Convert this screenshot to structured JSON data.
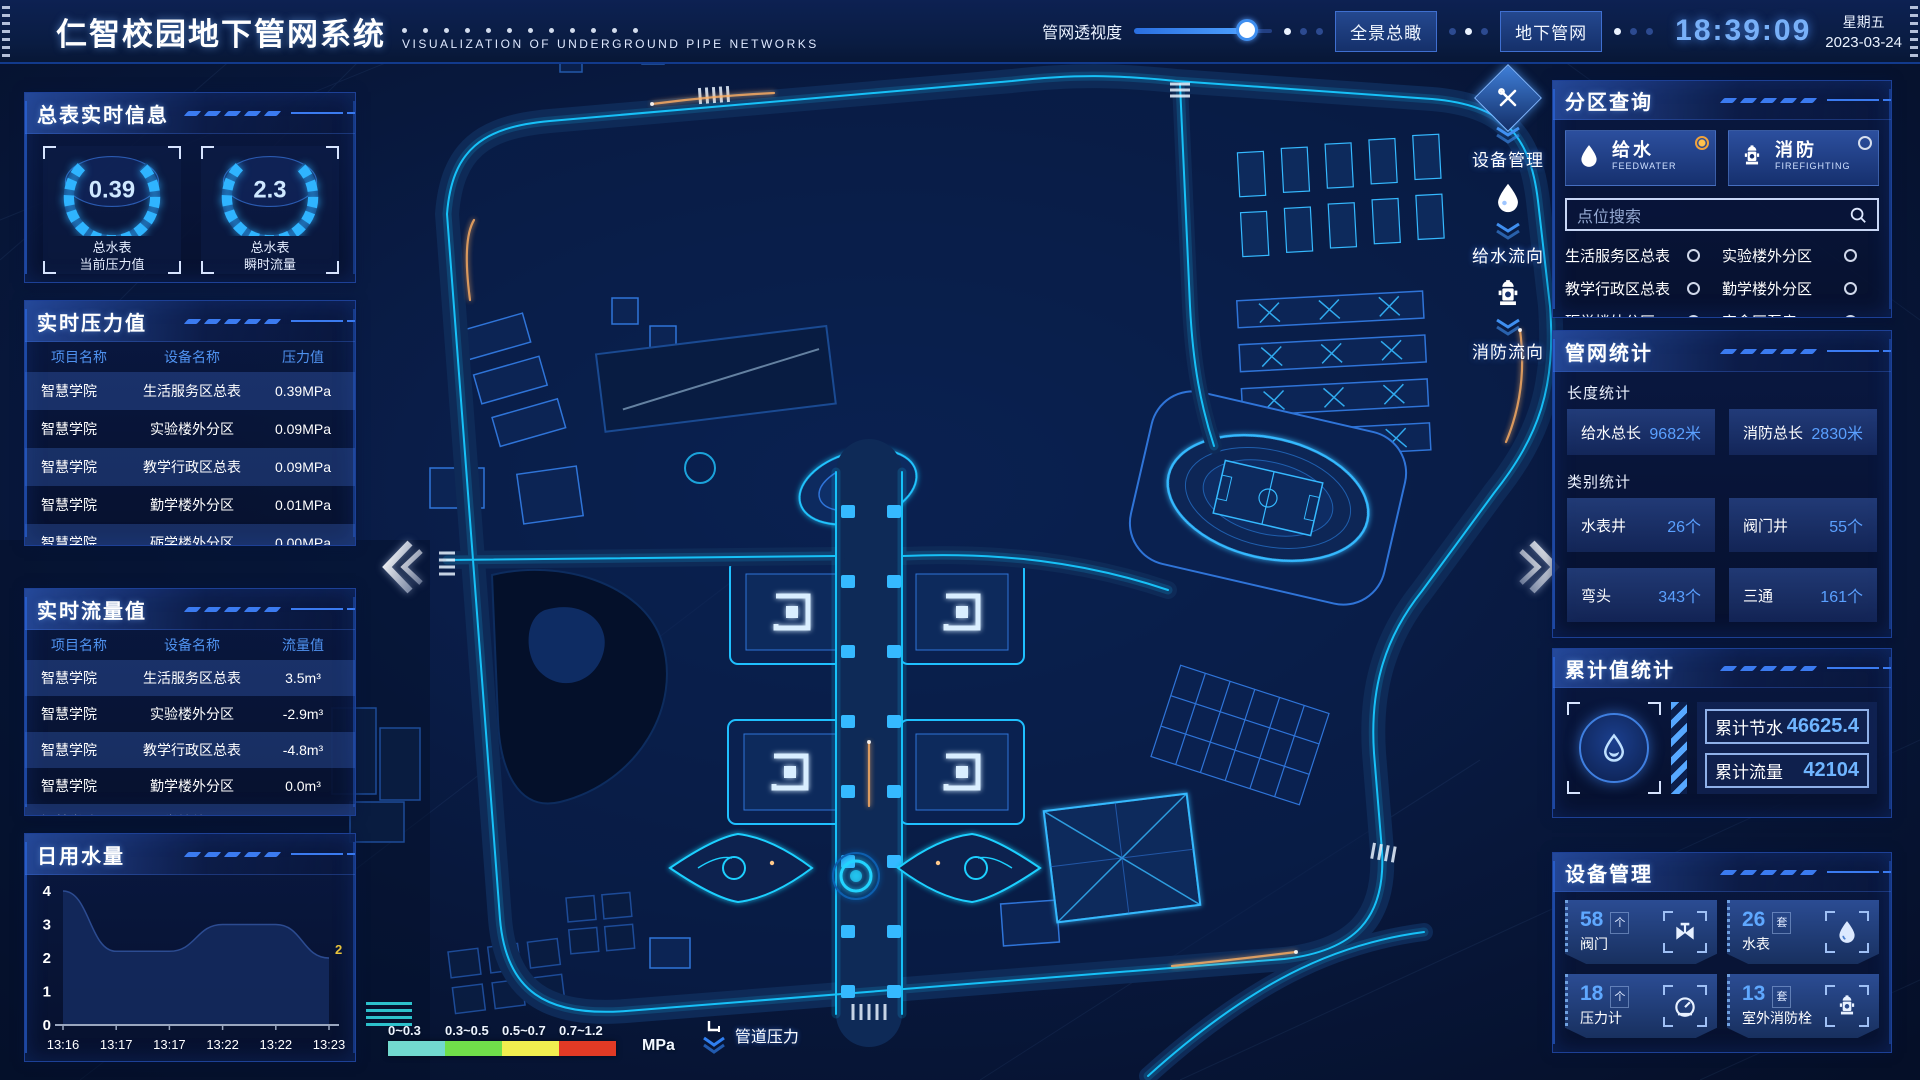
{
  "header": {
    "title": "仁智校园地下管网系统",
    "subtitle": "VISUALIZATION OF UNDERGROUND PIPE NETWORKS",
    "slider_label": "管网透视度",
    "slider_value": 82,
    "buttons": [
      {
        "label": "全景总瞰"
      },
      {
        "label": "地下管网"
      }
    ],
    "time": "18:39:09",
    "weekday": "星期五",
    "date": "2023-03-24"
  },
  "left": {
    "summary": {
      "title": "总表实时信息",
      "gauges": [
        {
          "value": "0.39",
          "label1": "总水表",
          "label2": "当前压力值"
        },
        {
          "value": "2.3",
          "label1": "总水表",
          "label2": "瞬时流量"
        }
      ]
    },
    "pressure": {
      "title": "实时压力值",
      "headers": [
        "项目名称",
        "设备名称",
        "压力值"
      ],
      "rows": [
        [
          "智慧学院",
          "生活服务区总表",
          "0.39MPa"
        ],
        [
          "智慧学院",
          "实验楼外分区",
          "0.09MPa"
        ],
        [
          "智慧学院",
          "教学行政区总表",
          "0.09MPa"
        ],
        [
          "智慧学院",
          "勤学楼外分区",
          "0.01MPa"
        ],
        [
          "智慧学院",
          "砺学楼外分区",
          "0.00MPa"
        ]
      ]
    },
    "flow": {
      "title": "实时流量值",
      "headers": [
        "项目名称",
        "设备名称",
        "流量值"
      ],
      "rows": [
        [
          "智慧学院",
          "生活服务区总表",
          "3.5m³"
        ],
        [
          "智慧学院",
          "实验楼外分区",
          "-2.9m³"
        ],
        [
          "智慧学院",
          "教学行政区总表",
          "-4.8m³"
        ],
        [
          "智慧学院",
          "勤学楼外分区",
          "0.0m³"
        ],
        [
          "智慧学院",
          "砺学楼外分区",
          "2.3m³"
        ]
      ]
    },
    "daily": {
      "title": "日用水量"
    }
  },
  "chart_data": {
    "type": "area",
    "title": "日用水量",
    "x": [
      "13:16",
      "13:17",
      "13:17",
      "13:22",
      "13:22",
      "13:23"
    ],
    "values": [
      4,
      2.2,
      2.2,
      3,
      3,
      2
    ],
    "ylim": [
      0,
      4
    ],
    "yticks": [
      0,
      1,
      2,
      3,
      4
    ],
    "end_label": "2",
    "grid": false,
    "legend": "none"
  },
  "right": {
    "zone": {
      "title": "分区查询",
      "tabs": [
        {
          "label": "给水",
          "sub": "FEEDWATER",
          "selected": true
        },
        {
          "label": "消防",
          "sub": "FIREFIGHTING",
          "selected": false
        }
      ],
      "search_placeholder": "点位搜索",
      "options": [
        "生活服务区总表",
        "实验楼外分区",
        "教学行政区总表",
        "勤学楼外分区",
        "砺学楼外分区",
        "宿舍区泵房"
      ]
    },
    "stats": {
      "title": "管网统计",
      "length_title": "长度统计",
      "length_items": [
        {
          "label": "给水总长",
          "value": "9682米"
        },
        {
          "label": "消防总长",
          "value": "2830米"
        }
      ],
      "category_title": "类别统计",
      "category_items": [
        {
          "label": "水表井",
          "value": "26个"
        },
        {
          "label": "阀门井",
          "value": "55个"
        },
        {
          "label": "弯头",
          "value": "343个"
        },
        {
          "label": "三通",
          "value": "161个"
        }
      ]
    },
    "cumulative": {
      "title": "累计值统计",
      "items": [
        {
          "label": "累计节水",
          "value": "46625.4"
        },
        {
          "label": "累计流量",
          "value": "42104"
        }
      ]
    },
    "devices": {
      "title": "设备管理",
      "cards": [
        {
          "count": "58",
          "unit": "个",
          "label": "阀门"
        },
        {
          "count": "26",
          "unit": "套",
          "label": "水表"
        },
        {
          "count": "18",
          "unit": "个",
          "label": "压力计"
        },
        {
          "count": "13",
          "unit": "套",
          "label": "室外消防栓"
        }
      ]
    }
  },
  "map": {
    "overlay_tools": [
      {
        "label": "设备管理"
      },
      {
        "label": "给水流向"
      },
      {
        "label": "消防流向"
      }
    ],
    "legend": {
      "ranges": [
        "0~0.3",
        "0.3~0.5",
        "0.5~0.7",
        "0.7~1.2"
      ],
      "colors": [
        "#72d9cf",
        "#70df4a",
        "#f1ee4f",
        "#e23a25"
      ],
      "unit": "MPa",
      "label": "管道压力"
    },
    "accent_colors": {
      "pipe_glow": "#18c8ff",
      "warm_accent": "#ffb063"
    }
  }
}
